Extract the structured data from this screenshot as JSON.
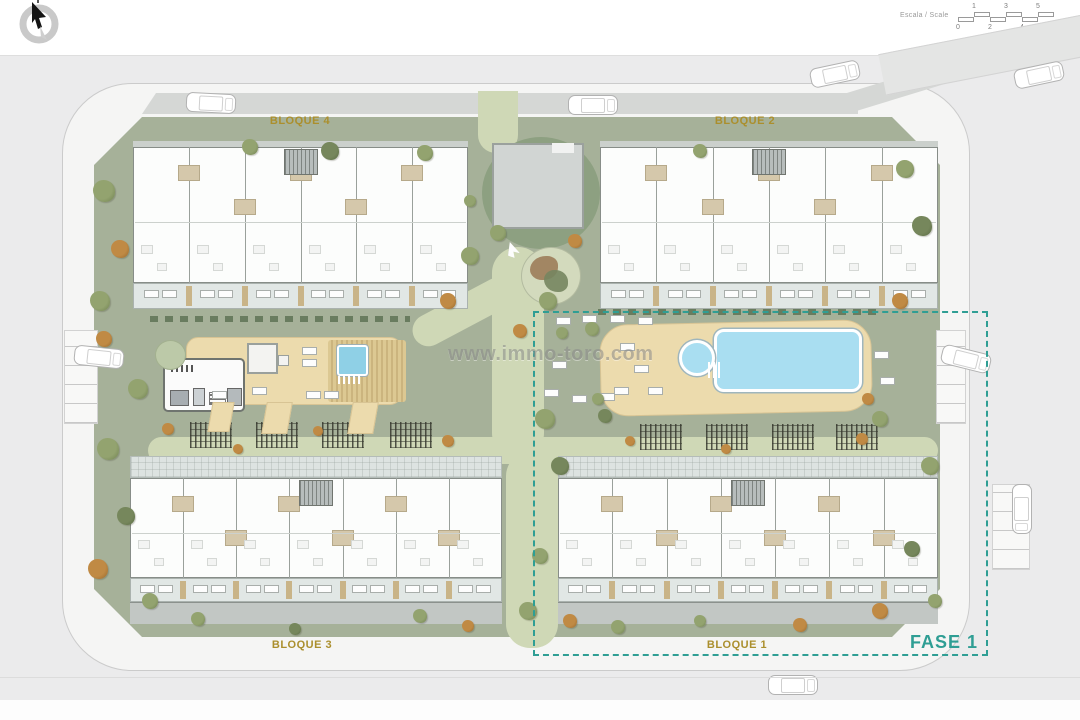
{
  "header": {
    "scale": {
      "label": "Escala / Scale",
      "ticks_top": [
        "1",
        "3",
        "5"
      ],
      "ticks_bottom": [
        "0",
        "2",
        "4",
        "6"
      ]
    }
  },
  "icons": {
    "compass": "compass-north-icon"
  },
  "watermark": "www.immo-toro.com",
  "blocks": [
    {
      "id": "bloque4",
      "label": "BLOQUE 4"
    },
    {
      "id": "bloque2",
      "label": "BLOQUE 2"
    },
    {
      "id": "bloque3",
      "label": "BLOQUE 3"
    },
    {
      "id": "bloque1",
      "label": "BLOQUE 1"
    }
  ],
  "phase": {
    "label": "FASE 1"
  },
  "colors": {
    "phase_accent": "#2f9e94",
    "block_label": "#ab8f2d",
    "site_green": "#a6b199",
    "path_green": "#cfd8b6",
    "deck_tan": "#ecdbad",
    "pool_blue": "#a9def1",
    "road_gray": "#ebebec",
    "band_gray": "#d5d7d5",
    "watermark_gray": "#8a8a8a"
  }
}
